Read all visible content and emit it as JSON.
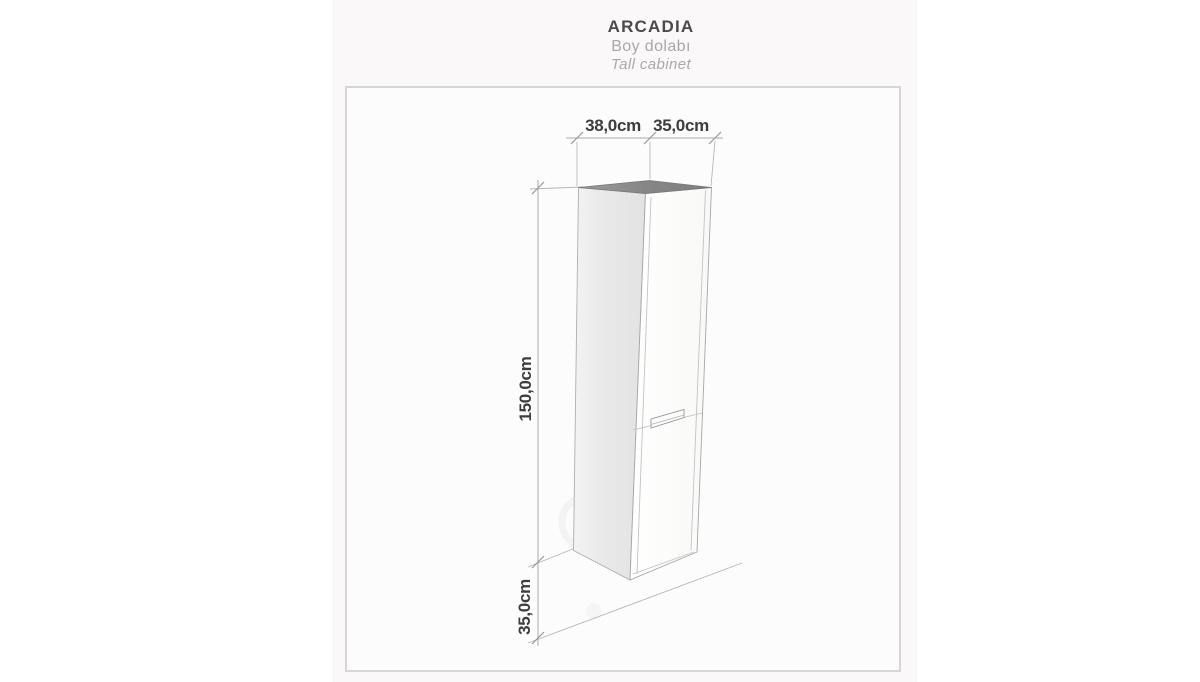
{
  "header": {
    "brand": "ARCADIA",
    "subtitle_tr": "Boy dolabı",
    "subtitle_en": "Tall cabinet"
  },
  "diagram": {
    "kind": "furniture-dimension-diagram",
    "product": "Tall cabinet",
    "dimensions": {
      "top_depth": "38,0cm",
      "top_width": "35,0cm",
      "height": "150,0cm",
      "bottom_depth": "35,0cm"
    }
  },
  "colors": {
    "page_bg": "#ffffff",
    "panel_bg": "#faf8f9",
    "frame_bg": "#fdfcfd",
    "frame_border": "#d6d6d8",
    "dim_text": "#3d3d3f",
    "muted_text": "#a7a7a9",
    "brand_text": "#4a4a4c",
    "cabinet_top": "#8a8a8c",
    "cabinet_side": "#e9e9e9",
    "cabinet_front": "#fcfcfb",
    "line": "#b6b6b8"
  }
}
